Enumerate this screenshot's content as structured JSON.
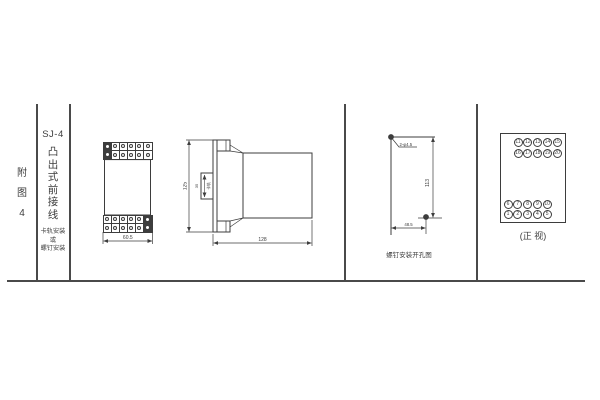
{
  "page": {
    "background": "#ffffff",
    "line_color": "#3d3d3d"
  },
  "sidebar": {
    "figure_label_chars": [
      "附",
      "图",
      "4"
    ],
    "model": "SJ-4",
    "title_chars": [
      "凸",
      "出",
      "式",
      "前",
      "接",
      "线"
    ],
    "mount_note_lines": [
      "卡轨安装",
      "或",
      "螺钉安装"
    ]
  },
  "front_view": {
    "width_dim": "60.5",
    "terminal_grid": {
      "rows": 2,
      "cols": 6
    },
    "filled_cells_top": [
      [
        0,
        0
      ],
      [
        1,
        0
      ]
    ],
    "filled_cells_bottom": [
      [
        0,
        5
      ],
      [
        1,
        5
      ]
    ]
  },
  "side_view": {
    "height_dim": "125",
    "rail_dim": "35",
    "rail_label": "卡轨",
    "depth_dim": "128"
  },
  "drill_view": {
    "hole_label": "2-φ4.5",
    "vertical_dim": "113",
    "horizontal_dim": "48.5",
    "caption": "螺钉安装开孔图"
  },
  "terminal_view": {
    "caption": "(正 视)",
    "top_rows": [
      [
        "11",
        "12",
        "13",
        "14",
        "15"
      ],
      [
        "16",
        "17",
        "18",
        "19",
        "20"
      ]
    ],
    "bottom_rows": [
      [
        "6",
        "7",
        "8",
        "9",
        "10"
      ],
      [
        "1",
        "2",
        "3",
        "4",
        "5"
      ]
    ]
  }
}
